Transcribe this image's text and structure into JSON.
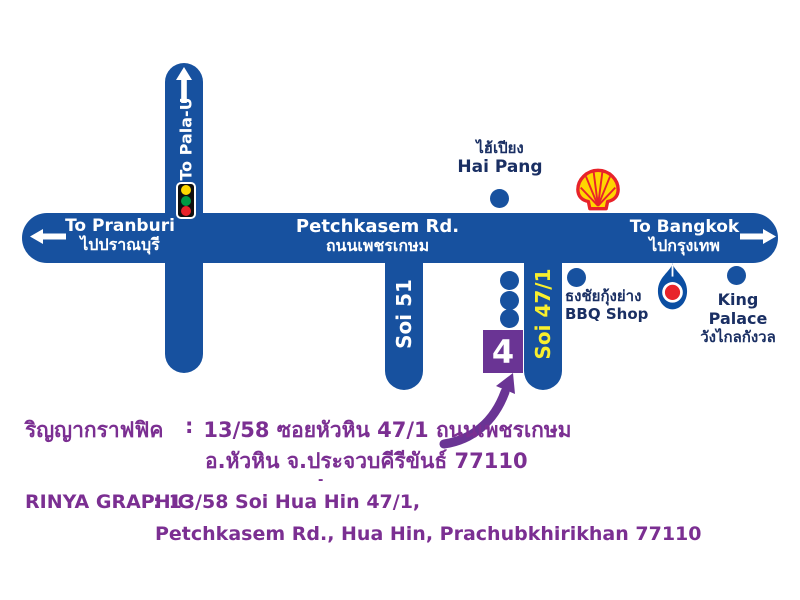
{
  "colors": {
    "road_blue": "#17519f",
    "navy_text": "#1a2f63",
    "purple_text": "#7b2f92",
    "marker_purple": "#6a3494",
    "soi471_yellow": "#f8ef2d",
    "shell_yellow": "#ffd500",
    "logo_red": "#e8232a",
    "ptt_blue": "#0b4ea2",
    "traffic_yellow": "#ffd900",
    "traffic_green": "#009a44",
    "traffic_red": "#e8232a"
  },
  "roads": {
    "petchkasem": {
      "name_en": "Petchkasem Rd.",
      "name_th": "ถนนเพชรเกษม"
    },
    "west": {
      "to_en": "To Pranburi",
      "to_th": "ไปปราณบุรี"
    },
    "east": {
      "to_en": "To Bangkok",
      "to_th": "ไปกรุงเทพ"
    },
    "north": {
      "to": "To Pala-U"
    },
    "soi51": {
      "name": "Soi 51"
    },
    "soi471": {
      "name": "Soi 47/1"
    }
  },
  "landmarks": {
    "hai_pang": {
      "name_th": "ไฮ้เปียง",
      "name_en": "Hai Pang"
    },
    "shell": {
      "icon": "shell-gas-station-logo"
    },
    "bbq": {
      "name_th": "ธงชัยกุ้งย่าง",
      "name_en": "BBQ Shop"
    },
    "ptt": {
      "icon": "ptt-gas-station-logo"
    },
    "king_palace": {
      "name_en": "King Palace",
      "name_th": "วังไกลกังวล"
    }
  },
  "marker": {
    "label": "4"
  },
  "address": {
    "th_label": "ริญญากราฟฟิค",
    "th_sep": ":",
    "th_line1": "13/58 ซอยหัวหิน 47/1 ถนนเพชรเกษม",
    "th_line2": "อ.หัวหิน จ.ประจวบคีรีขันธ์ 77110",
    "en_label": "RINYA GRAPHIC",
    "en_sep": ":",
    "en_line1": "13/58 Soi Hua Hin 47/1,",
    "en_line2": "Petchkasem Rd., Hua Hin, Prachubkhirikhan 77110",
    "dash": "-"
  }
}
